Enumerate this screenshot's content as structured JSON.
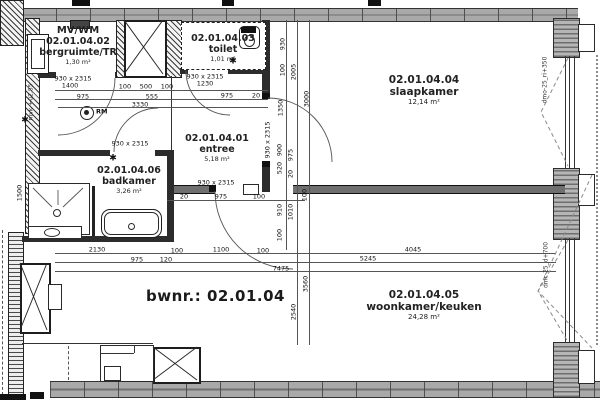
{
  "plan": {
    "unit_label": "bwnr.: 02.01.04",
    "rooms": [
      {
        "extra": "MV/WM",
        "code": "02.01.04.02",
        "name": "bergruimte/TR",
        "area": "1,30 m²"
      },
      {
        "code": "02.01.04.03",
        "name": "toilet",
        "area": "1,01 m²"
      },
      {
        "code": "02.01.04.04",
        "name": "slaapkamer",
        "area": "12,14 m²"
      },
      {
        "code": "02.01.04.01",
        "name": "entree",
        "area": "5,18 m²"
      },
      {
        "code": "02.01.04.06",
        "name": "badkamer",
        "area": "3,26 m²"
      },
      {
        "code": "02.01.04.05",
        "name": "woonkamer/keuken",
        "area": "24,28 m²"
      }
    ]
  },
  "labels": [
    {
      "t": "930 x 2315",
      "x": 73,
      "y": 79
    },
    {
      "t": "1400",
      "x": 70,
      "y": 86
    },
    {
      "t": "100",
      "x": 125,
      "y": 87
    },
    {
      "t": "500",
      "x": 146,
      "y": 87
    },
    {
      "t": "100",
      "x": 167,
      "y": 87
    },
    {
      "t": "975",
      "x": 83,
      "y": 97
    },
    {
      "t": "555",
      "x": 152,
      "y": 97
    },
    {
      "t": "3330",
      "x": 140,
      "y": 105
    },
    {
      "t": "930 x 2315",
      "x": 205,
      "y": 77
    },
    {
      "t": "1230",
      "x": 205,
      "y": 84
    },
    {
      "t": "975",
      "x": 227,
      "y": 96
    },
    {
      "t": "20",
      "x": 256,
      "y": 96
    },
    {
      "t": "930 x 2315",
      "x": 130,
      "y": 144
    },
    {
      "t": "930 x 2315",
      "x": 216,
      "y": 183
    },
    {
      "t": "930 x 2315",
      "x": 268,
      "y": 140,
      "r": 1
    },
    {
      "t": "20",
      "x": 184,
      "y": 197
    },
    {
      "t": "975",
      "x": 221,
      "y": 197
    },
    {
      "t": "100",
      "x": 259,
      "y": 197
    },
    {
      "t": "2130",
      "x": 97,
      "y": 250
    },
    {
      "t": "100",
      "x": 177,
      "y": 251
    },
    {
      "t": "1100",
      "x": 221,
      "y": 250
    },
    {
      "t": "100",
      "x": 263,
      "y": 251
    },
    {
      "t": "975",
      "x": 137,
      "y": 260
    },
    {
      "t": "120",
      "x": 166,
      "y": 260
    },
    {
      "t": "7475",
      "x": 281,
      "y": 269
    },
    {
      "t": "4045",
      "x": 413,
      "y": 250
    },
    {
      "t": "5245",
      "x": 368,
      "y": 259
    },
    {
      "t": "930",
      "x": 283,
      "y": 44,
      "r": 1
    },
    {
      "t": "100",
      "x": 283,
      "y": 70,
      "r": 1
    },
    {
      "t": "2005",
      "x": 294,
      "y": 72,
      "r": 1
    },
    {
      "t": "1350",
      "x": 281,
      "y": 108,
      "r": 1
    },
    {
      "t": "3000",
      "x": 307,
      "y": 99,
      "r": 1
    },
    {
      "t": "900",
      "x": 280,
      "y": 150,
      "r": 1
    },
    {
      "t": "975",
      "x": 291,
      "y": 155,
      "r": 1
    },
    {
      "t": "520",
      "x": 280,
      "y": 168,
      "r": 1
    },
    {
      "t": "20",
      "x": 291,
      "y": 174,
      "r": 1
    },
    {
      "t": "100",
      "x": 305,
      "y": 195,
      "r": 1
    },
    {
      "t": "910",
      "x": 280,
      "y": 210,
      "r": 1
    },
    {
      "t": "1010",
      "x": 291,
      "y": 212,
      "r": 1
    },
    {
      "t": "100",
      "x": 280,
      "y": 235,
      "r": 1
    },
    {
      "t": "1500",
      "x": 20,
      "y": 193,
      "r": 1
    },
    {
      "t": "3560",
      "x": 306,
      "y": 284,
      "r": 1
    },
    {
      "t": "2540",
      "x": 294,
      "y": 312,
      "r": 1
    },
    {
      "t": "dmo-25_ri+350",
      "x": 545,
      "y": 80,
      "r": 1,
      "c": "note"
    },
    {
      "t": "dmc-25_d+700",
      "x": 546,
      "y": 265,
      "r": 1,
      "c": "note"
    },
    {
      "t": "mvk +02,85",
      "x": 31,
      "y": 102,
      "r": 1,
      "c": "note"
    },
    {
      "t": "✱",
      "x": 25,
      "y": 121,
      "c": "star"
    },
    {
      "t": "✱",
      "x": 233,
      "y": 62,
      "c": "star"
    },
    {
      "t": "✱",
      "x": 113,
      "y": 159,
      "c": "star"
    },
    {
      "t": "RM",
      "x": 96,
      "y": 112,
      "c": "rm"
    }
  ]
}
